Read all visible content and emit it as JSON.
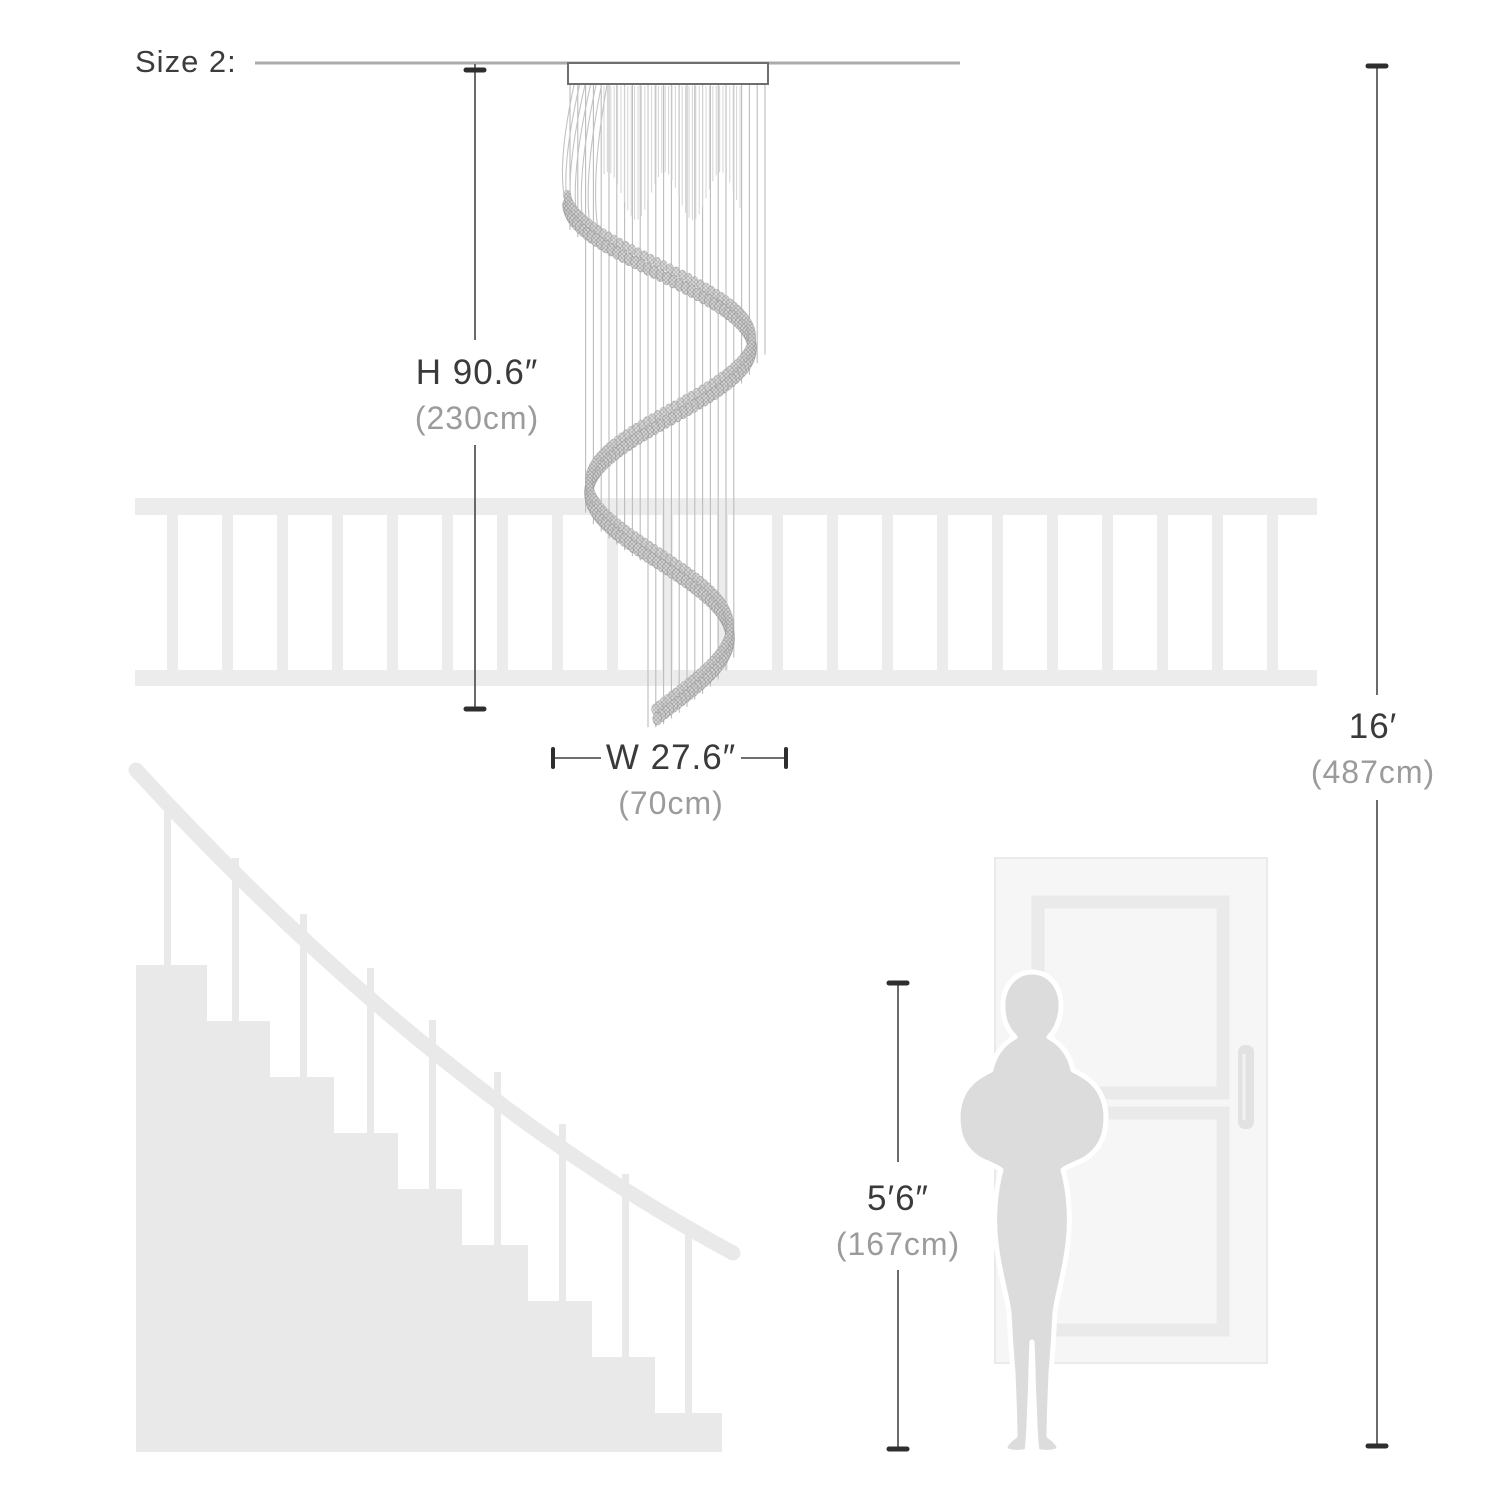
{
  "header": {
    "size_label": "Size 2:"
  },
  "annotations": {
    "chandelier_height": {
      "imperial": "H 90.6″",
      "metric": "(230cm)"
    },
    "chandelier_width": {
      "imperial": "W 27.6″",
      "metric": "(70cm)"
    },
    "ceiling_height": {
      "imperial": "16′",
      "metric": "(487cm)"
    },
    "person_height": {
      "imperial": "5′6″",
      "metric": "(167cm)"
    }
  },
  "colors": {
    "dimension_text": "#3a3a3a",
    "metric_text": "#9b9b9b",
    "dimension_line": "#5a5a5a",
    "tick": "#2e2e2e",
    "ceiling_line": "#ababab",
    "chandelier_strand": "#bcbcbc",
    "chandelier_bead": "#c9c9c9",
    "silhouette_gray": "#e9e9e9",
    "person_gray": "#dcdcdc",
    "door_slab": "#f6f6f6",
    "door_panel_band": "#eaeaea"
  }
}
